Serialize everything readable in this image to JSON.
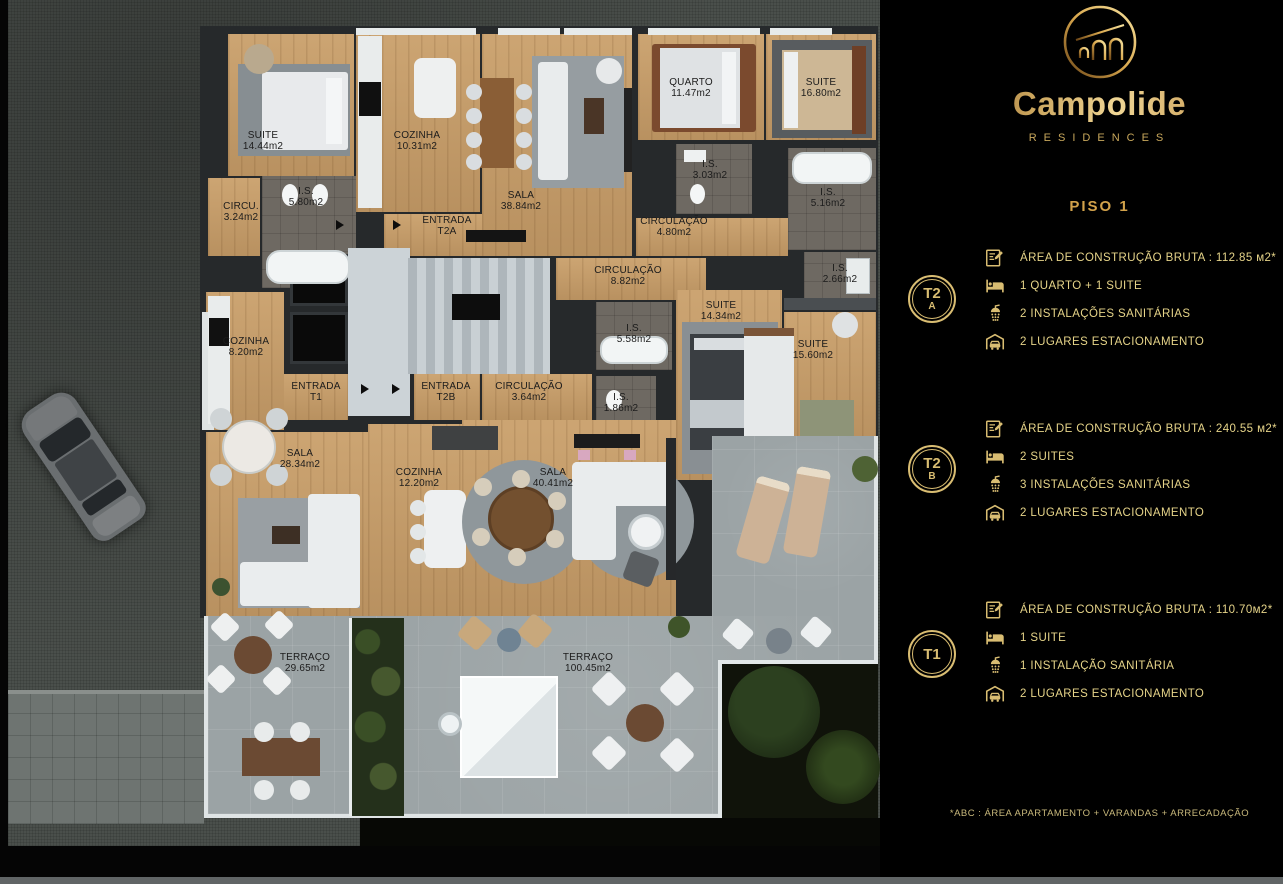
{
  "brand": {
    "name": "Campolide",
    "subtitle": "RESIDENCES"
  },
  "floor_title": "PISO 1",
  "units": [
    {
      "id": "T2A",
      "badge_top": "T2",
      "badge_bottom": "A",
      "specs": [
        "ÁREA DE CONSTRUÇÃO BRUTA :  112.85 м2*",
        "1 QUARTO + 1 SUITE",
        "2 INSTALAÇÕES SANITÁRIAS",
        "2 LUGARES ESTACIONAMENTO"
      ]
    },
    {
      "id": "T2B",
      "badge_top": "T2",
      "badge_bottom": "B",
      "specs": [
        "ÁREA DE CONSTRUÇÃO BRUTA :  240.55 м2*",
        "2 SUITES",
        "3 INSTALAÇÕES SANITÁRIAS",
        "2 LUGARES ESTACIONAMENTO"
      ]
    },
    {
      "id": "T1",
      "badge_top": "T1",
      "badge_bottom": "",
      "specs": [
        "ÁREA DE CONSTRUÇÃO BRUTA :  110.70м2*",
        "1 SUITE",
        "1 INSTALAÇÃO SANITÁRIA",
        "2 LUGARES ESTACIONAMENTO"
      ]
    }
  ],
  "footnote": "*ABC :  ÁREA APARTAMENTO + VARANDAS + ARRECADAÇÃO",
  "colors": {
    "gold": "#d9bd72",
    "panel_bg": "#000000",
    "wood": "#c49a66",
    "tile": "#9ba3a5"
  },
  "floorplan": {
    "rooms": [
      {
        "n": "SUITE",
        "a": "14.44m2",
        "x": 228,
        "y": 34,
        "w": 126,
        "h": 142,
        "k": "wood",
        "lx": 263,
        "ly": 141
      },
      {
        "n": "COZINHA",
        "a": "10.31m2",
        "x": 356,
        "y": 34,
        "w": 124,
        "h": 178,
        "k": "wood",
        "lx": 417,
        "ly": 141
      },
      {
        "n": "SALA",
        "a": "38.84m2",
        "x": 482,
        "y": 34,
        "w": 150,
        "h": 222,
        "k": "wood",
        "lx": 521,
        "ly": 201
      },
      {
        "n": "CIRCU.",
        "a": "3.24m2",
        "x": 208,
        "y": 178,
        "w": 52,
        "h": 78,
        "k": "wood",
        "lx": 241,
        "ly": 212
      },
      {
        "n": "I.S.",
        "a": "5.80m2",
        "x": 262,
        "y": 176,
        "w": 94,
        "h": 112,
        "k": "bath",
        "lx": 306,
        "ly": 197
      },
      {
        "n": "ENTRADA",
        "a": "T2A",
        "x": 384,
        "y": 214,
        "w": 98,
        "h": 42,
        "k": "wood",
        "lx": 447,
        "ly": 226
      },
      {
        "n": "QUARTO",
        "a": "11.47m2",
        "x": 638,
        "y": 34,
        "w": 126,
        "h": 106,
        "k": "wood",
        "lx": 691,
        "ly": 88
      },
      {
        "n": "SUITE",
        "a": "16.80m2",
        "x": 766,
        "y": 34,
        "w": 110,
        "h": 106,
        "k": "wood",
        "lx": 821,
        "ly": 88
      },
      {
        "n": "I.S.",
        "a": "3.03m2",
        "x": 676,
        "y": 144,
        "w": 76,
        "h": 70,
        "k": "bath",
        "lx": 710,
        "ly": 170
      },
      {
        "n": "I.S.",
        "a": "5.16m2",
        "x": 788,
        "y": 148,
        "w": 88,
        "h": 102,
        "k": "bath",
        "lx": 828,
        "ly": 198
      },
      {
        "n": "CIRCULAÇÃO",
        "a": "4.80m2",
        "x": 636,
        "y": 218,
        "w": 152,
        "h": 38,
        "k": "wood",
        "lx": 674,
        "ly": 227
      },
      {
        "n": "CIRCULAÇÃO",
        "a": "8.82m2",
        "x": 556,
        "y": 258,
        "w": 150,
        "h": 42,
        "k": "wood",
        "lx": 628,
        "ly": 276
      },
      {
        "n": "I.S.",
        "a": "5.58m2",
        "x": 596,
        "y": 302,
        "w": 76,
        "h": 68,
        "k": "bath",
        "lx": 634,
        "ly": 334
      },
      {
        "n": "SUITE",
        "a": "14.34m2",
        "x": 676,
        "y": 290,
        "w": 106,
        "h": 190,
        "k": "wood",
        "lx": 721,
        "ly": 311
      },
      {
        "n": "I.S.",
        "a": "2.66m2",
        "x": 804,
        "y": 252,
        "w": 72,
        "h": 48,
        "k": "bath",
        "lx": 840,
        "ly": 274
      },
      {
        "n": "SUITE",
        "a": "15.60m2",
        "x": 784,
        "y": 312,
        "w": 92,
        "h": 132,
        "k": "wood",
        "lx": 813,
        "ly": 350
      },
      {
        "n": "I.S.",
        "a": "1.86m2",
        "x": 596,
        "y": 376,
        "w": 60,
        "h": 68,
        "k": "bath",
        "lx": 621,
        "ly": 403
      },
      {
        "n": "CIRCULAÇÃO",
        "a": "3.64m2",
        "x": 482,
        "y": 374,
        "w": 110,
        "h": 46,
        "k": "wood",
        "lx": 529,
        "ly": 392
      },
      {
        "n": "ENTRADA",
        "a": "T1",
        "x": 282,
        "y": 374,
        "w": 66,
        "h": 46,
        "k": "wood",
        "lx": 316,
        "ly": 392
      },
      {
        "n": "ENTRADA",
        "a": "T2B",
        "x": 414,
        "y": 374,
        "w": 66,
        "h": 46,
        "k": "wood",
        "lx": 446,
        "ly": 392
      },
      {
        "n": "COZINHA",
        "a": "8.20m2",
        "x": 206,
        "y": 292,
        "w": 78,
        "h": 138,
        "k": "wood",
        "lx": 246,
        "ly": 347
      },
      {
        "n": "SALA",
        "a": "28.34m2",
        "x": 206,
        "y": 432,
        "w": 162,
        "h": 184,
        "k": "wood",
        "lx": 300,
        "ly": 459
      },
      {
        "n": "COZINHA",
        "a": "12.20m2",
        "x": 368,
        "y": 424,
        "w": 94,
        "h": 192,
        "k": "wood",
        "lx": 419,
        "ly": 478
      },
      {
        "n": "SALA",
        "a": "40.41m2",
        "x": 462,
        "y": 420,
        "w": 214,
        "h": 196,
        "k": "wood",
        "lx": 553,
        "ly": 478
      },
      {
        "n": "TERRAÇO",
        "a": "29.65m2",
        "x": 0,
        "y": 0,
        "w": 0,
        "h": 0,
        "k": "none",
        "lx": 305,
        "ly": 663
      },
      {
        "n": "TERRAÇO",
        "a": "100.45m2",
        "x": 0,
        "y": 0,
        "w": 0,
        "h": 0,
        "k": "none",
        "lx": 588,
        "ly": 663
      }
    ]
  }
}
